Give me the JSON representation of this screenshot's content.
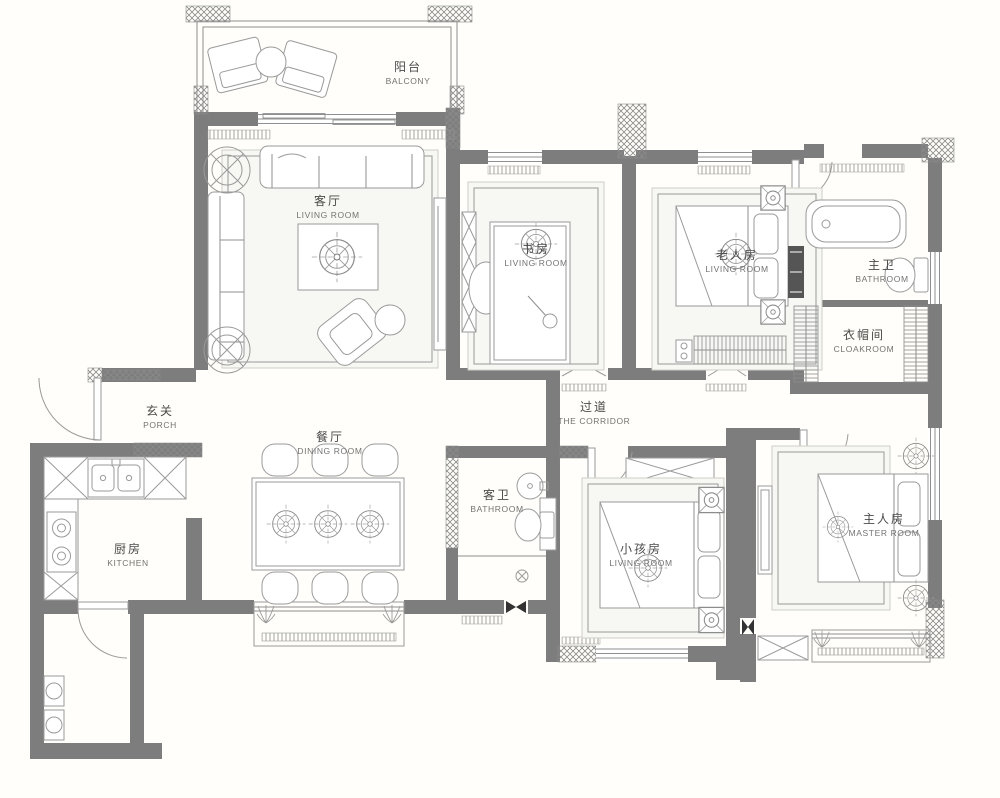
{
  "drawing": "residential-floor-plan",
  "colors": {
    "background": "#fffefa",
    "wall": "#7d7d7d",
    "line": "#8f8f8f",
    "furniture": "#9a9a9a",
    "text": "#4a4a4a",
    "door_leaf_black": "#333333"
  },
  "rooms": [
    {
      "id": "balcony",
      "zh": "阳台",
      "en": "BALCONY"
    },
    {
      "id": "living-room",
      "zh": "客厅",
      "en": "LIVING ROOM"
    },
    {
      "id": "study",
      "zh": "书房",
      "en": "LIVING ROOM"
    },
    {
      "id": "elderly-room",
      "zh": "老人房",
      "en": "LIVING ROOM"
    },
    {
      "id": "master-bathroom",
      "zh": "主卫",
      "en": "BATHROOM"
    },
    {
      "id": "cloakroom",
      "zh": "衣帽间",
      "en": "CLOAKROOM"
    },
    {
      "id": "porch",
      "zh": "玄关",
      "en": "PORCH"
    },
    {
      "id": "dining-room",
      "zh": "餐厅",
      "en": "DINING ROOM"
    },
    {
      "id": "corridor",
      "zh": "过道",
      "en": "THE CORRIDOR"
    },
    {
      "id": "guest-bathroom",
      "zh": "客卫",
      "en": "BATHROOM"
    },
    {
      "id": "kids-room",
      "zh": "小孩房",
      "en": "LIVING ROOM"
    },
    {
      "id": "master-room",
      "zh": "主人房",
      "en": "MASTER ROOM"
    },
    {
      "id": "kitchen",
      "zh": "厨房",
      "en": "KITCHEN"
    }
  ],
  "symbols": [
    "ceiling-fan",
    "ac-unit-box",
    "plant",
    "door-swing-arc",
    "black-door-leaf",
    "wardrobe-strip",
    "bay-window"
  ]
}
